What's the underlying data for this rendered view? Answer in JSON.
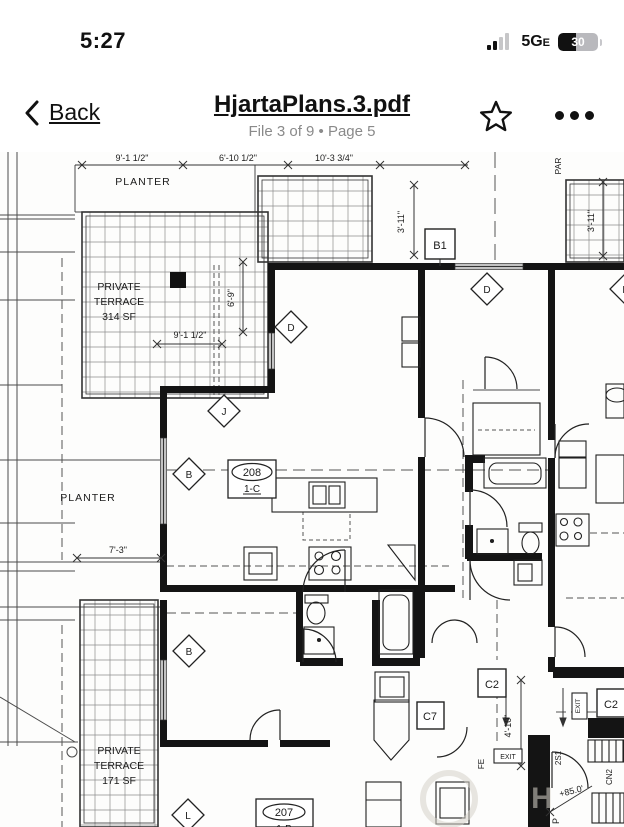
{
  "status_bar": {
    "time": "5:27",
    "network": "5G",
    "network_sub": "E",
    "battery_level": "30"
  },
  "nav_bar": {
    "back_label": "Back",
    "title": "HjartaPlans.3.pdf",
    "subtitle": "File 3 of 9 • Page 5"
  },
  "plan": {
    "dimensions": {
      "top1": "9'-1 1/2\"",
      "top2": "6'-10 1/2\"",
      "top3": "10'-3 3/4\"",
      "left_v1": "6'-9\"",
      "left_h1": "9'-1 1/2\"",
      "left_h2": "7'-3\"",
      "right_v1": "3'-11\"",
      "right_v2": "3'-11\"",
      "corridor_v": "4'-10\"",
      "elevation": "+85.0'"
    },
    "labels": {
      "planter_top": "PLANTER",
      "planter_mid": "PLANTER",
      "terrace_top": {
        "l1": "PRIVATE",
        "l2": "TERRACE",
        "l3": "314 SF"
      },
      "terrace_bottom": {
        "l1": "PRIVATE",
        "l2": "TERRACE",
        "l3": "171 SF"
      },
      "parapet": "PAR",
      "fire_ext": "FE",
      "exit1": "EXIT",
      "exit2": "EXIT",
      "stair1": "2S1",
      "note_cn": "CN2",
      "p": "P"
    },
    "markers": {
      "b1": "B1",
      "c2a": "C2",
      "c2b": "C2",
      "c7": "C7",
      "d1": "D",
      "d2": "D",
      "d3": "D",
      "j": "J",
      "b_a": "B",
      "b_b": "B",
      "l": "L"
    },
    "units": {
      "u208": {
        "number": "208",
        "type": "1-C"
      },
      "u207": {
        "number": "207",
        "type": "1-B"
      }
    }
  }
}
